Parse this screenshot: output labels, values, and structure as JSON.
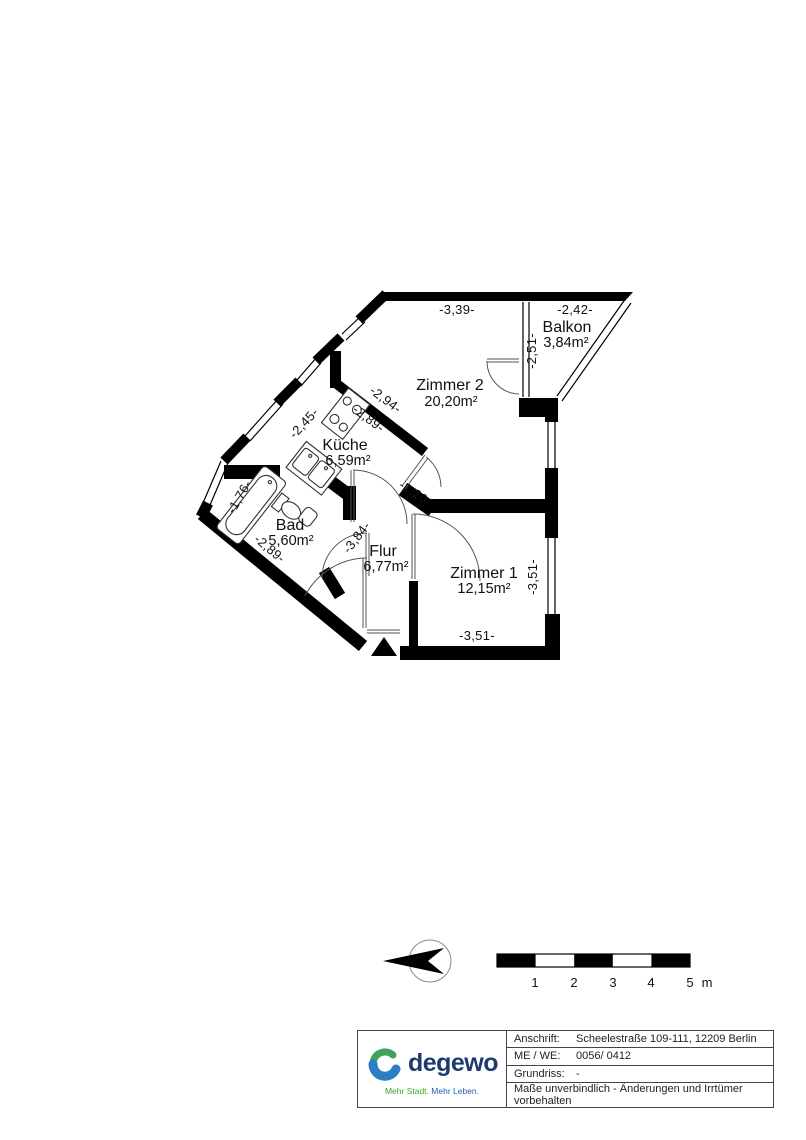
{
  "plan": {
    "rooms": [
      {
        "id": "zimmer2",
        "name": "Zimmer 2",
        "area": "20,20m²"
      },
      {
        "id": "balkon",
        "name": "Balkon",
        "area": "3,84m²"
      },
      {
        "id": "kueche",
        "name": "Küche",
        "area": "6,59m²"
      },
      {
        "id": "bad",
        "name": "Bad",
        "area": "5,60m²"
      },
      {
        "id": "flur",
        "name": "Flur",
        "area": "6,77m²"
      },
      {
        "id": "zimmer1",
        "name": "Zimmer 1",
        "area": "12,15m²"
      }
    ],
    "dimensions": [
      {
        "id": "dim-top-width",
        "text": "-3,39-"
      },
      {
        "id": "dim-balkon-width",
        "text": "-2,42-"
      },
      {
        "id": "dim-balkon-depth",
        "text": "-2,51-"
      },
      {
        "id": "dim-kueche-wall",
        "text": "-2,94-"
      },
      {
        "id": "dim-kueche-inner",
        "text": "-2,89-"
      },
      {
        "id": "dim-kueche-window",
        "text": "-2,45-"
      },
      {
        "id": "dim-bad-window",
        "text": "-1,76-"
      },
      {
        "id": "dim-bad-wall",
        "text": "-2,89-"
      },
      {
        "id": "dim-flur-length",
        "text": "-3,84-"
      },
      {
        "id": "dim-passage",
        "text": "-1,20-"
      },
      {
        "id": "dim-zimmer1-height",
        "text": "-3,51-"
      },
      {
        "id": "dim-zimmer1-width",
        "text": "-3,51-"
      }
    ],
    "icons": {
      "north_arrow": "compass-needle-pointing-left",
      "entrance_marker": "entrance-triangle"
    }
  },
  "scalebar": {
    "labels": [
      "1",
      "2",
      "3",
      "4",
      "5"
    ],
    "unit": "m"
  },
  "titleblock": {
    "logo": {
      "brand": "degewo",
      "tagline_part1": "Mehr Stadt.",
      "tagline_part2": "Mehr Leben."
    },
    "rows": [
      {
        "label": "Anschrift:",
        "value": "Scheelestraße 109-111, 12209 Berlin"
      },
      {
        "label": "ME / WE:",
        "value": "0056/ 0412"
      },
      {
        "label": "Grundriss:",
        "value": "-"
      }
    ],
    "disclaimer": "Maße unverbindlich - Änderungen und Irrtümer vorbehalten"
  },
  "colors": {
    "wall": "#000000",
    "brand_navy": "#1e3a6e",
    "brand_blue": "#2b7fc2",
    "brand_green": "#3fa45a",
    "tagline_green": "#3fa42a",
    "tagline_blue": "#1e5fa8"
  }
}
